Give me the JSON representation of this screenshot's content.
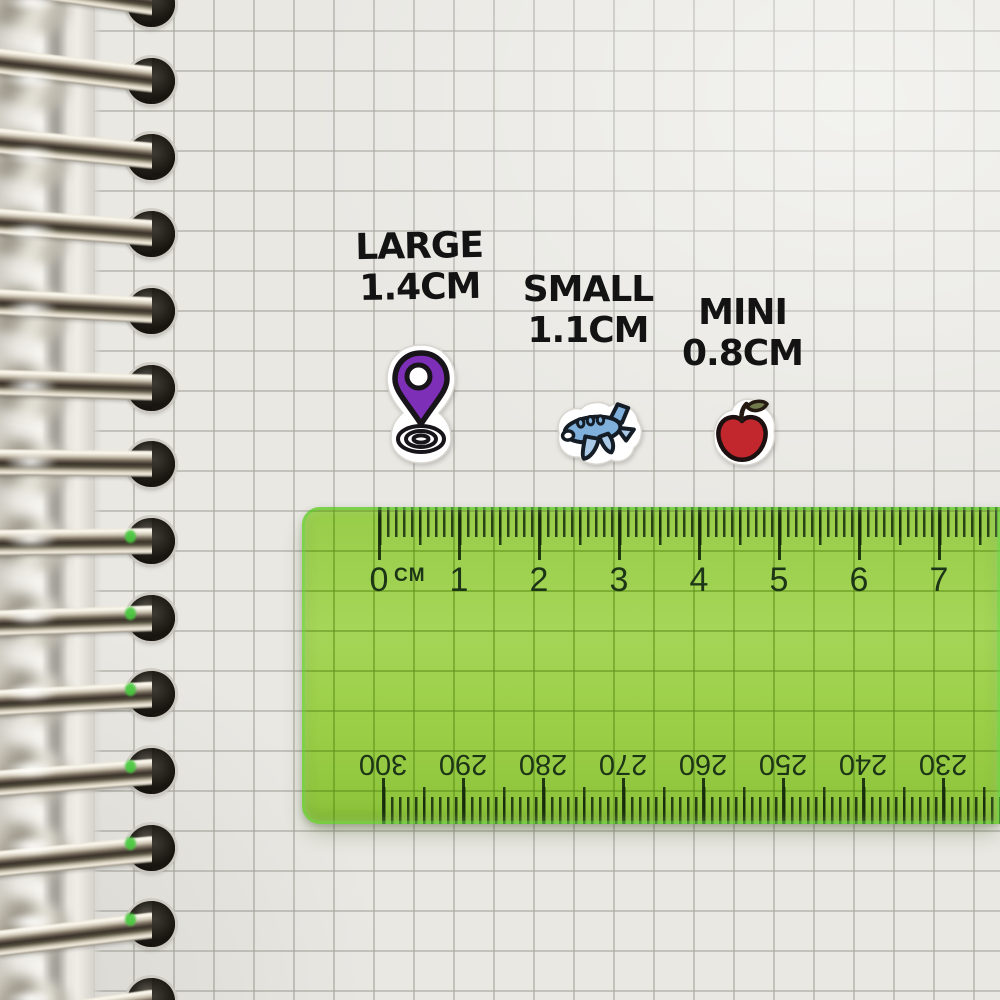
{
  "content": {
    "size_labels": [
      {
        "title": "LARGE",
        "size": "1.4CM",
        "sticker": "location-pin"
      },
      {
        "title": "SMALL",
        "size": "1.1CM",
        "sticker": "airplane"
      },
      {
        "title": "MINI",
        "size": "0.8CM",
        "sticker": "apple"
      }
    ]
  },
  "ruler": {
    "unit_label": "CM",
    "top_scale_cm": [
      "0",
      "1",
      "2",
      "3",
      "4",
      "5",
      "6",
      "7"
    ],
    "bottom_scale_mm": [
      "300",
      "290",
      "280",
      "270",
      "260",
      "250",
      "240",
      "230"
    ],
    "body_color": "#8ec445",
    "tick_color": "#1d3517"
  },
  "colors": {
    "paper": "#e9e8e3",
    "grid_line": "#b9b8b1",
    "sticker_border": "#ffffff",
    "pin_purple": "#7e2fb8",
    "plane_blue": "#7fb0dc",
    "plane_blue_light": "#a9c9e6",
    "apple_red": "#c1272d",
    "leaf_olive": "#717a4a",
    "outline_black": "#17141a",
    "metal_silver": "#cfc6b4",
    "ruler_green": "#8ec445"
  }
}
